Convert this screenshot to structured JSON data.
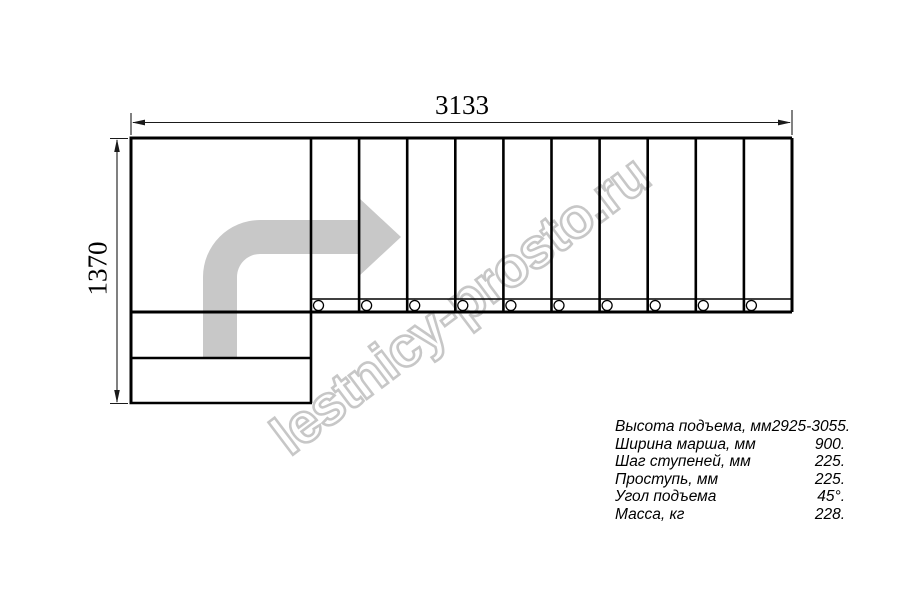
{
  "drawing": {
    "width_dimension": "3133",
    "height_dimension": "1370",
    "tread_count": 10,
    "colors": {
      "line": "#000000",
      "dimension_line": "#1a1a1a",
      "arrow_fill": "#c8c8c8",
      "watermark_outline": "#c7c7c7"
    }
  },
  "watermark": {
    "text": "lestnicy-prosto.ru"
  },
  "specs": {
    "rows": [
      {
        "label": "Высота подъема, мм",
        "value": "2925-3055."
      },
      {
        "label": "Ширина марша, мм",
        "value": "900."
      },
      {
        "label": "Шаг ступеней, мм",
        "value": "225."
      },
      {
        "label": "Проступь, мм",
        "value": "225."
      },
      {
        "label": "Угол подъема",
        "value": "45°."
      },
      {
        "label": "Масса, кг",
        "value": "228."
      }
    ]
  }
}
